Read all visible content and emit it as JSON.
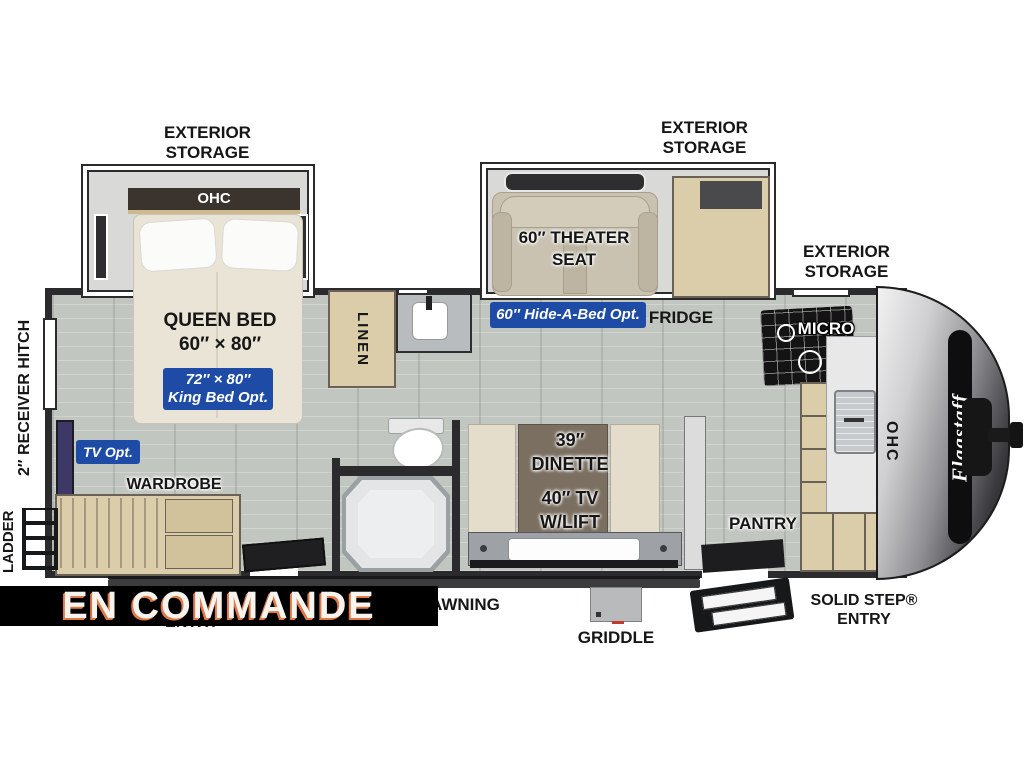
{
  "colors": {
    "accent_blue": "#1d4ba6",
    "banner_bg": "#000000",
    "banner_text": "#f7f3ef",
    "banner_shadow": "#e07a45",
    "wall": "#2b2b2d",
    "floor": "#c2c6c0",
    "cabinet_wood": "#dbcda9"
  },
  "banner": {
    "text": "EN COMMANDE"
  },
  "exterior": {
    "storage_left": "EXTERIOR STORAGE",
    "storage_center": "EXTERIOR STORAGE",
    "storage_right": "EXTERIOR STORAGE",
    "receiver_hitch": "2″ RECEIVER HITCH",
    "ladder": "LADDER",
    "awning": "AWNING",
    "griddle": "GRIDDLE",
    "entry_partial": "ENTRY",
    "solid_step_line1": "SOLID STEP®",
    "solid_step_line2": "ENTRY",
    "brand": "Flagstaff"
  },
  "bedroom": {
    "ohc": "OHC",
    "bed_title": "QUEEN BED",
    "bed_size": "60″ × 80″",
    "king_line1": "72″ × 80″",
    "king_line2": "King Bed Opt.",
    "tv_opt": "TV Opt.",
    "wardrobe": "WARDROBE"
  },
  "bath": {
    "linen": "LINEN"
  },
  "living": {
    "theater_line1": "60″ THEATER",
    "theater_line2": "SEAT",
    "hide_a_bed": "60″ Hide-A-Bed Opt.",
    "fridge": "FRIDGE"
  },
  "dinette": {
    "line1": "39″",
    "line2": "DINETTE",
    "line3": "40″ TV",
    "line4": "W/LIFT"
  },
  "kitchen": {
    "micro": "MICRO",
    "pantry": "PANTRY",
    "ohc": "OHC"
  }
}
